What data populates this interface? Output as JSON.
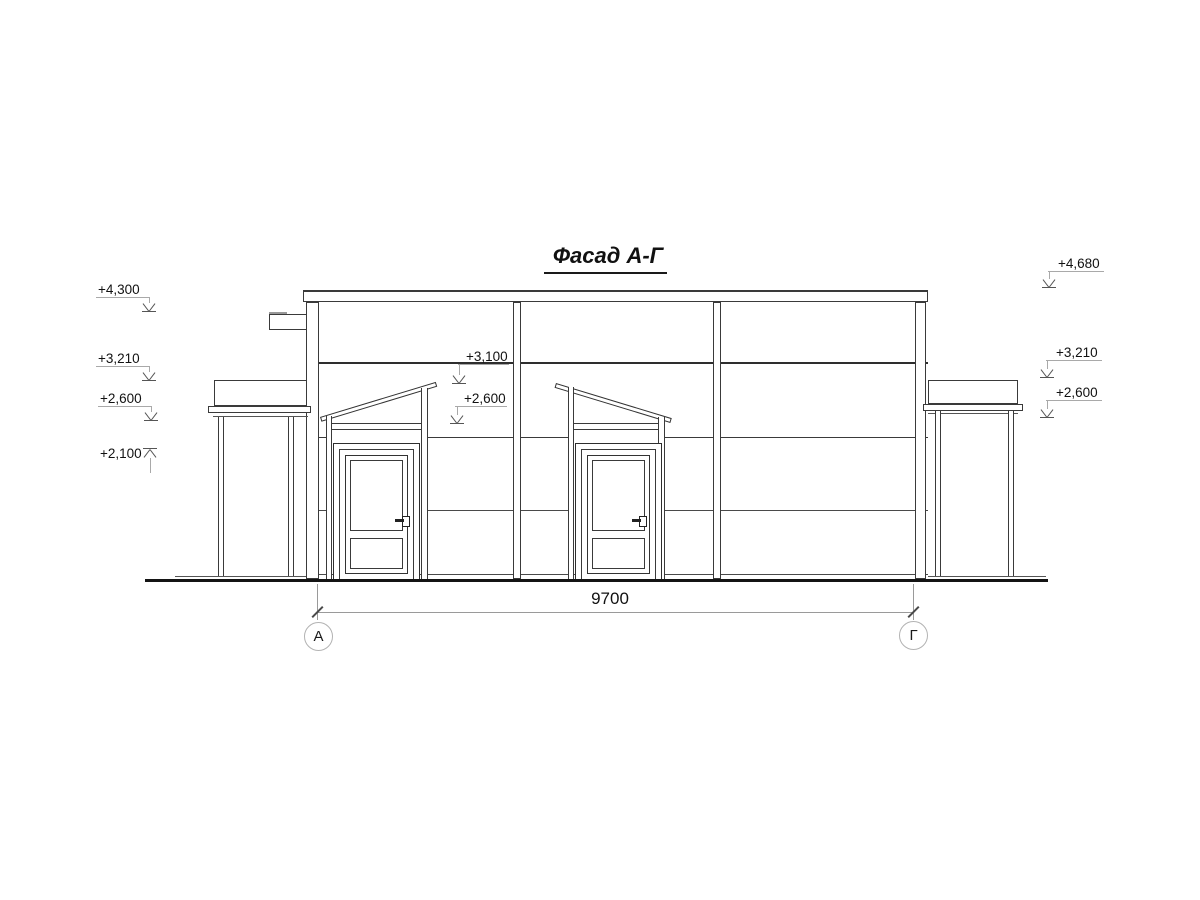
{
  "drawing": {
    "title": "Фасад А-Г",
    "dimension_total": "9700",
    "axis_left": "А",
    "axis_right": "Г"
  },
  "elevation_marks": {
    "left": [
      "+4,300",
      "+3,210",
      "+2,600",
      "+2,100"
    ],
    "center": [
      "+3,100",
      "+2,600"
    ],
    "right": [
      "+4,680",
      "+3,210",
      "+2,600"
    ]
  }
}
